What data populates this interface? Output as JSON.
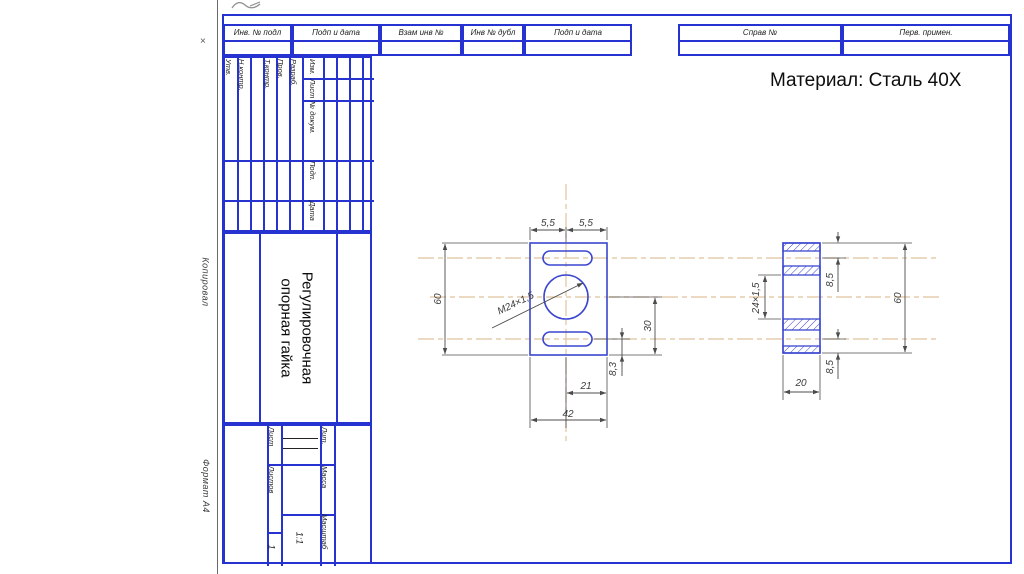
{
  "note": {
    "material": "Материал: Сталь 40Х"
  },
  "frame": {
    "top_cells": [
      "Инв. № подл",
      "Подп и дата",
      "Взам инв №",
      "Инв № дубл",
      "Подп и дата"
    ],
    "right_cells": [
      "Справ №",
      "Перв. примен."
    ],
    "margin": {
      "copied": "Копировал",
      "format": "Формат  А4",
      "mark": "×"
    }
  },
  "titleblock": {
    "sign_columns": [
      "Утв.",
      "Н.контр.",
      "Т.контр.",
      "Пров.",
      "Разраб."
    ],
    "header_cells": [
      "Изм.",
      "Лист",
      "№ докум.",
      "Подп.",
      "Дата"
    ],
    "part_title_lines": [
      "Регулировочная",
      "опорная гайка"
    ],
    "bottom": {
      "sheet_label": "Лист",
      "sheets_label": "Листов",
      "sheets_value": "1",
      "lit_label": "Лит.",
      "mass_label": "Масса",
      "scale_label": "Масштаб",
      "scale_value": "1:1"
    }
  },
  "drawing": {
    "dims": {
      "top_left": "5,5",
      "top_right": "5,5",
      "height": "60",
      "center_to_bottom": "30",
      "slot_to_edge": "8,3",
      "half_width": "21",
      "width": "42",
      "thread": "М24×1,5",
      "sec_top": "8,5",
      "sec_bottom": "8,5",
      "sec_height": "60",
      "sec_width": "20",
      "sec_thread": "24×1,5"
    }
  },
  "colors": {
    "frame_blue": "#2633d0",
    "part_blue": "#3a46cf",
    "dim_gray": "#4c4c4c",
    "centerline_tan": "#dfc49c"
  }
}
